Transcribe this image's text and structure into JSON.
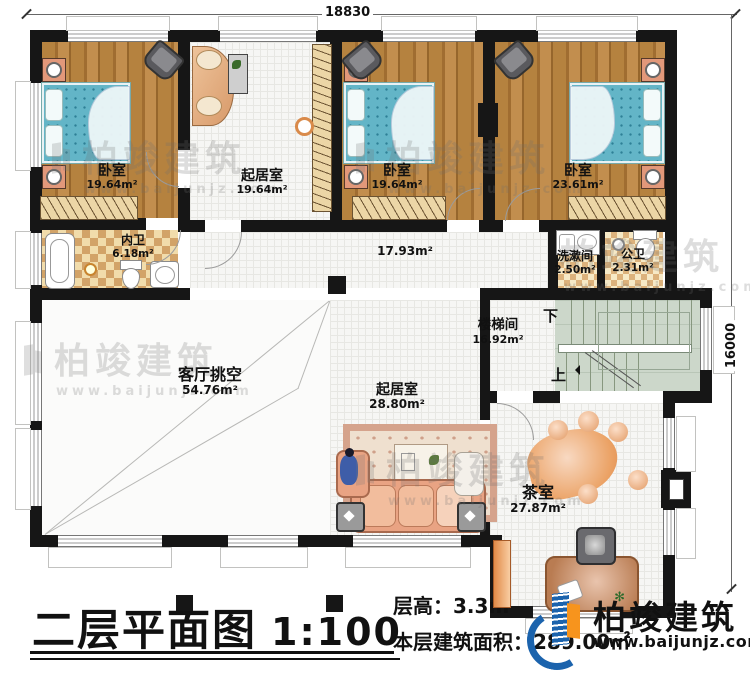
{
  "annotations": {
    "dim_top": "18830",
    "dim_right": "16000"
  },
  "rooms": [
    {
      "id": "bedroom-1",
      "name": "卧室",
      "area": "19.64m²"
    },
    {
      "id": "study",
      "name": "起居室",
      "area": "19.64m²"
    },
    {
      "id": "bedroom-2",
      "name": "卧室",
      "area": "19.64m²"
    },
    {
      "id": "bedroom-3",
      "name": "卧室",
      "area": "23.61m²"
    },
    {
      "id": "inner-bath",
      "name": "内卫",
      "area": "6.18m²"
    },
    {
      "id": "hallway",
      "name": "",
      "area": "17.93m²"
    },
    {
      "id": "washroom",
      "name": "洗漱间",
      "area": "2.50m²"
    },
    {
      "id": "public-bath",
      "name": "公卫",
      "area": "2.31m²"
    },
    {
      "id": "stairwell",
      "name": "楼梯间",
      "area": "16.92m²"
    },
    {
      "id": "living-void",
      "name": "客厅挑空",
      "area": "54.76m²"
    },
    {
      "id": "living-room",
      "name": "起居室",
      "area": "28.80m²"
    },
    {
      "id": "tea-room",
      "name": "茶室",
      "area": "27.87m²"
    }
  ],
  "stairs": {
    "down_label": "下",
    "up_label": "上"
  },
  "title_block": {
    "title": "二层平面图",
    "scale": "1:100",
    "floor_height_label": "层高：",
    "floor_height": "3.3m",
    "area_label": "本层建筑面积：",
    "area_value": "289.00㎡"
  },
  "logo": {
    "name": "柏竣建筑",
    "website": "www.baijunjz.com",
    "brand_blue": "#1b63ad",
    "brand_orange": "#f7941d"
  },
  "watermark": {
    "text": "柏竣建筑",
    "subtext": "www.baijunjz.com"
  }
}
